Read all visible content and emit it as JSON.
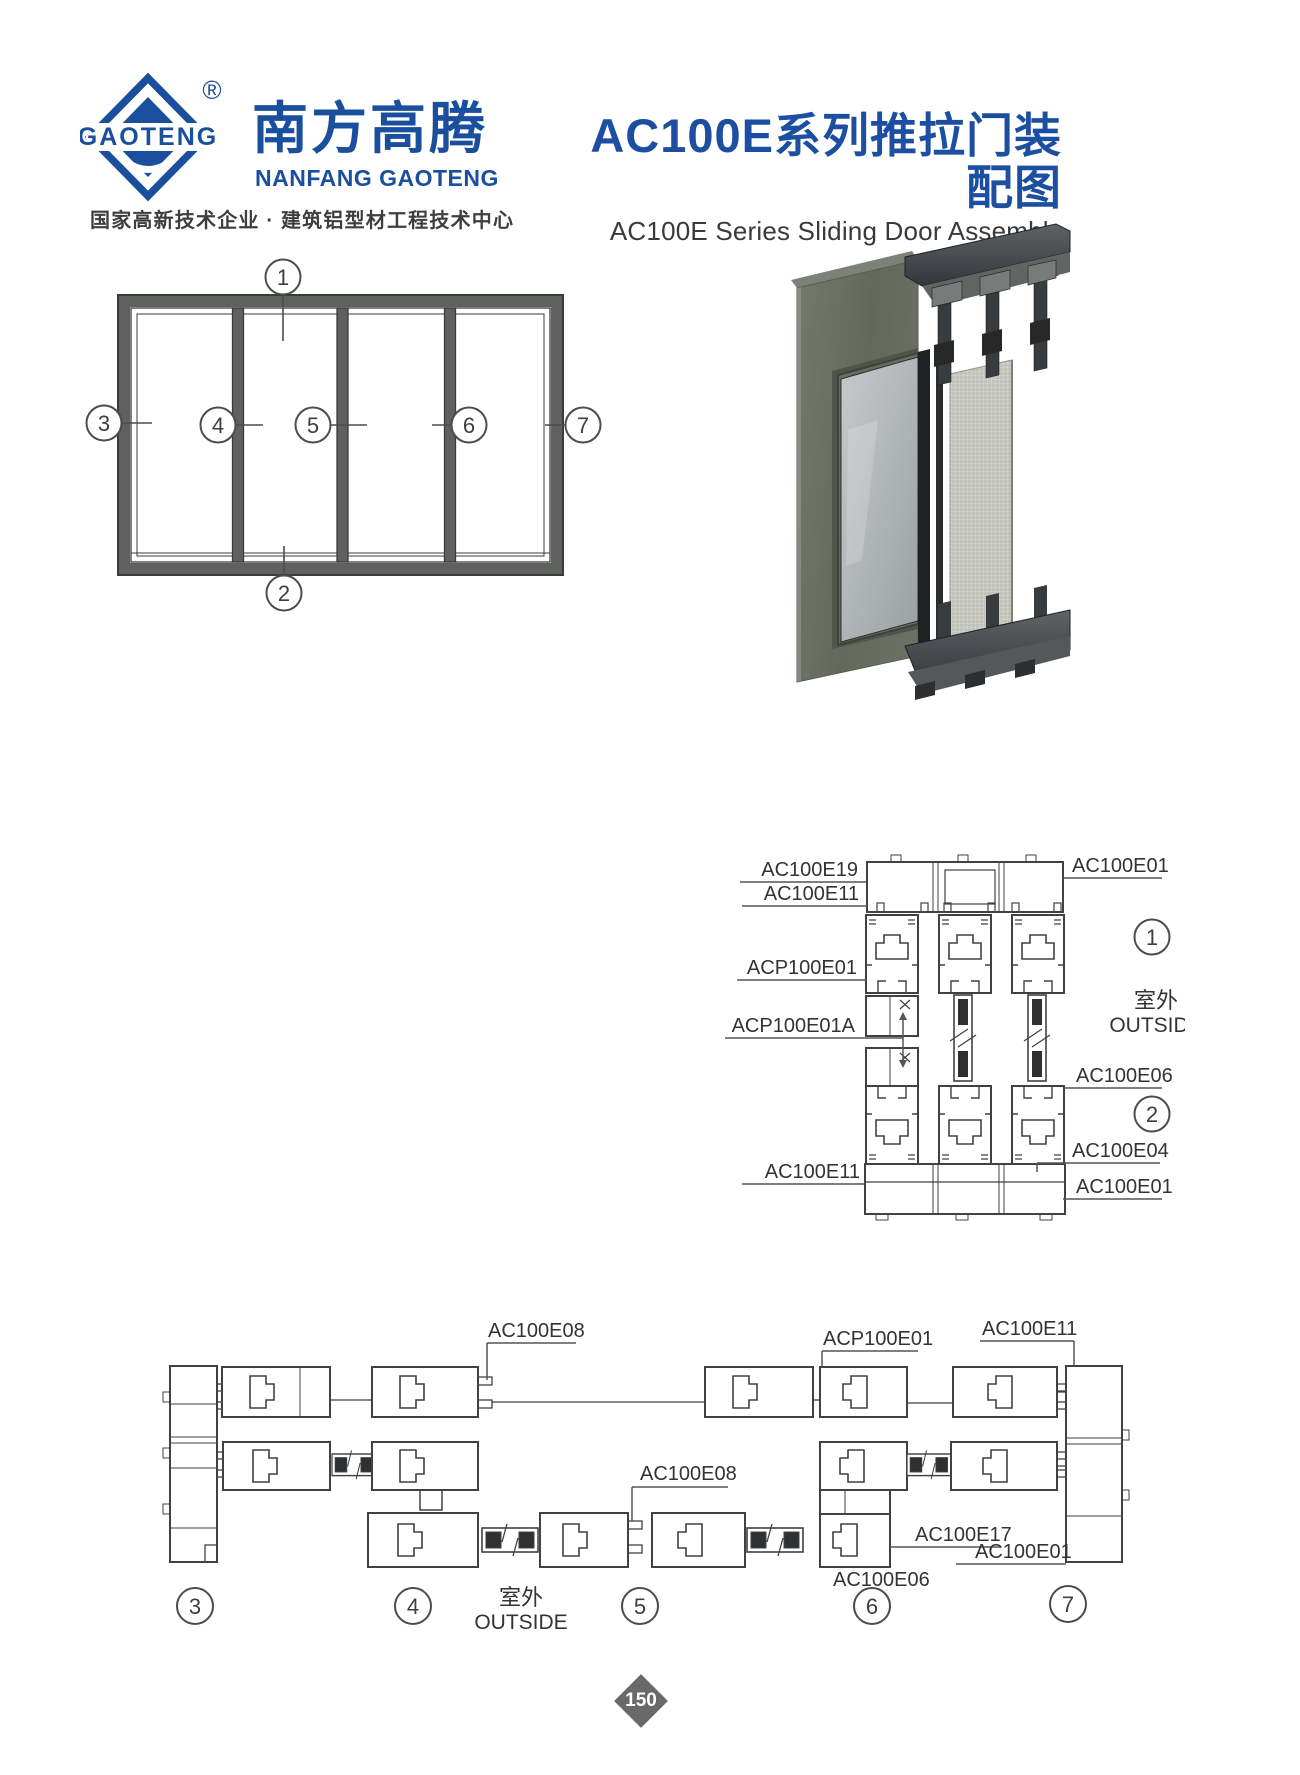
{
  "brand": {
    "logo_text": "GAOTENG",
    "registered": "®",
    "name_cn": "南方高腾",
    "name_en": "NANFANG GAOTENG",
    "tagline": "国家高新技术企业 · 建筑铝型材工程技术中心"
  },
  "title": {
    "cn": "AC100E系列推拉门装配图",
    "en": "AC100E Series Sliding Door Assembly Drawing"
  },
  "elev": {
    "c1": "1",
    "c2": "2",
    "c3": "3",
    "c4": "4",
    "c5": "5",
    "c6": "6",
    "c7": "7"
  },
  "vsec": {
    "e19": "AC100E19",
    "e11t": "AC100E11",
    "p01": "ACP100E01",
    "p01a": "ACP100E01A",
    "e11b": "AC100E11",
    "e01t": "AC100E01",
    "e06": "AC100E06",
    "e04": "AC100E04",
    "e01b": "AC100E01",
    "c1": "1",
    "c2": "2",
    "out_cn": "室外",
    "out_en": "OUTSIDE"
  },
  "hsec": {
    "e08a": "AC100E08",
    "e08b": "AC100E08",
    "p01": "ACP100E01",
    "e11": "AC100E11",
    "e17": "AC100E17",
    "e01": "AC100E01",
    "e06": "AC100E06",
    "c3": "3",
    "c4": "4",
    "c5": "5",
    "c6": "6",
    "c7": "7",
    "out_cn": "室外",
    "out_en": "OUTSIDE"
  },
  "footer": {
    "page": "150"
  },
  "colors": {
    "brand_blue": "#1a4f9d",
    "title_blue": "#1c4fa1",
    "line": "#3f4143",
    "frame_gray": "#5e615e"
  }
}
